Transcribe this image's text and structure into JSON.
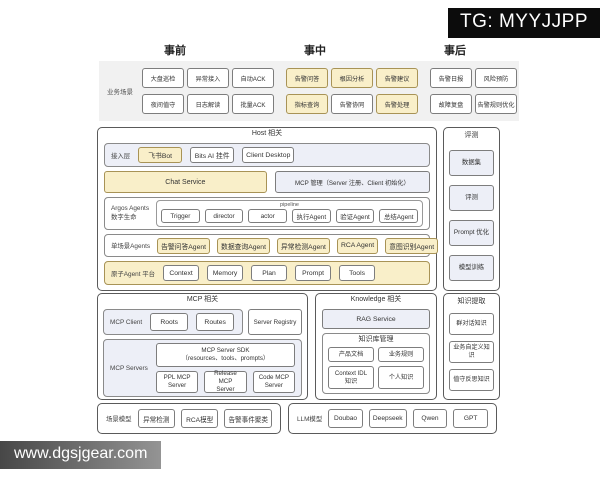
{
  "watermarks": {
    "top_right": "TG: MYYJJPP",
    "bottom_left": "www.dgsjgear.com"
  },
  "phases": {
    "pre": "事前",
    "mid": "事中",
    "post": "事后"
  },
  "scenarios": {
    "label": "业务场景",
    "row1": [
      {
        "label": "大盘巡检"
      },
      {
        "label": "异常接入"
      },
      {
        "label": "自动ACK"
      },
      {
        "label": "告警问答",
        "cls": "hl ggap"
      },
      {
        "label": "根因分析",
        "cls": "hl"
      },
      {
        "label": "告警建议",
        "cls": "hl"
      },
      {
        "label": "告警日报",
        "cls": "ggap"
      },
      {
        "label": "风险预防"
      }
    ],
    "row2": [
      {
        "label": "夜间值守"
      },
      {
        "label": "日志解读"
      },
      {
        "label": "批量ACK"
      },
      {
        "label": "指标查询",
        "cls": "hl ggap"
      },
      {
        "label": "告警协同"
      },
      {
        "label": "告警处理",
        "cls": "hl"
      },
      {
        "label": "故障复盘",
        "cls": "ggap"
      },
      {
        "label": "告警规则优化"
      }
    ]
  },
  "host": {
    "title": "Host 相关",
    "access": {
      "label": "接入层",
      "items": [
        {
          "label": "飞书Bot",
          "cls": "hl"
        },
        {
          "label": "Bits AI 挂件"
        },
        {
          "label": "Client Desktop"
        }
      ]
    },
    "chat_service": "Chat Service",
    "mcp_mgmt": "MCP 管理（Server 注册、Client 初始化）",
    "argos": {
      "label": "Argos Agents\n数字生命",
      "pipeline": "pipeline",
      "items": [
        "Trigger",
        "director",
        "actor",
        "执行Agent",
        "验证Agent",
        "总结Agent"
      ]
    },
    "single_scene": {
      "label": "单场景Agents",
      "items": [
        {
          "label": "告警问答Agent",
          "cls": "hl"
        },
        {
          "label": "数据查询Agent",
          "cls": "hl"
        },
        {
          "label": "异常检测Agent",
          "cls": "hl"
        },
        {
          "label": "RCA Agent",
          "cls": "hl"
        },
        {
          "label": "意图识别Agent",
          "cls": "hl"
        }
      ]
    },
    "atomic": {
      "label": "原子Agent 平台",
      "items": [
        "Context",
        "Memory",
        "Plan",
        "Prompt",
        "Tools"
      ]
    }
  },
  "evaluation": {
    "title": "评测",
    "items": [
      {
        "label": "数据集",
        "cls": "blue"
      },
      {
        "label": "评测",
        "cls": "blue"
      },
      {
        "label": "Prompt 优化",
        "cls": "blue"
      },
      {
        "label": "模型训练",
        "cls": "blue"
      }
    ]
  },
  "mcp": {
    "title": "MCP 相关",
    "client": {
      "label": "MCP Client",
      "items": [
        "Roots",
        "Routes"
      ]
    },
    "server_registry": "Server Registry",
    "servers": {
      "label": "MCP Servers",
      "sdk_line1": "MCP Server SDK",
      "sdk_line2": "（resources、tools、prompts）",
      "items": [
        "PPL MCP\nServer",
        "Release MCP\nServer",
        "Code MCP\nServer"
      ]
    }
  },
  "knowledge": {
    "title": "Knowledge 相关",
    "rag": "RAG Service",
    "kb": {
      "title": "知识库管理",
      "items": [
        "产品文档",
        "业务规则",
        "Context IDL 知识",
        "个人知识"
      ]
    }
  },
  "extraction": {
    "title": "知识提取",
    "items": [
      "群对话知识",
      "业务自定义知识",
      "值守反思知识"
    ]
  },
  "scene_models": {
    "label": "场景模型",
    "items": [
      "异常检测",
      "RCA模型",
      "告警事件聚类"
    ]
  },
  "llm_models": {
    "label": "LLM模型",
    "items": [
      "Doubao",
      "Deepseek",
      "Qwen",
      "GPT"
    ]
  },
  "colors": {
    "highlight_fill": "#f9efc9",
    "highlight_border": "#a89356",
    "panel_fill": "#edeff7",
    "scenario_bg": "#f1f1f1",
    "watermark_bg": "#0c0c0c"
  }
}
